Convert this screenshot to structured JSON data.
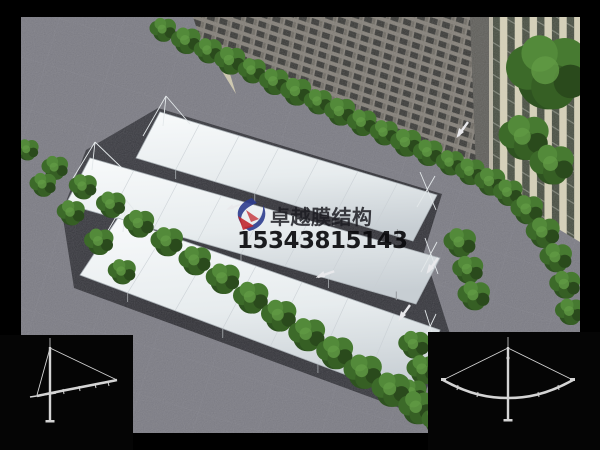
{
  "watermark": {
    "brand": "卓越膜结构",
    "phone": "15343815143",
    "brand_color": "#1c1c22",
    "phone_color": "#0a0a0d",
    "logo_colors": {
      "blue": "#2c3c8e",
      "red": "#c1272d"
    }
  },
  "scene": {
    "subject": "membrane-structure-carport-aerial-render",
    "canopy_color": "#eef2f4",
    "pavement_color": "#73737b",
    "parking_lot_color": "#26262b",
    "tree_color": "#3c6a29",
    "building_facade_color": "#8a857a",
    "building_glass_color": "#30302c",
    "building_side_color": "#d6d0b4",
    "background_color": "#000000"
  },
  "diagrams": {
    "left": "single-cantilever-frame-profile",
    "right": "double-cantilever-frame-profile",
    "line_color": "#d4d4d4",
    "panel_color": "#050505"
  }
}
